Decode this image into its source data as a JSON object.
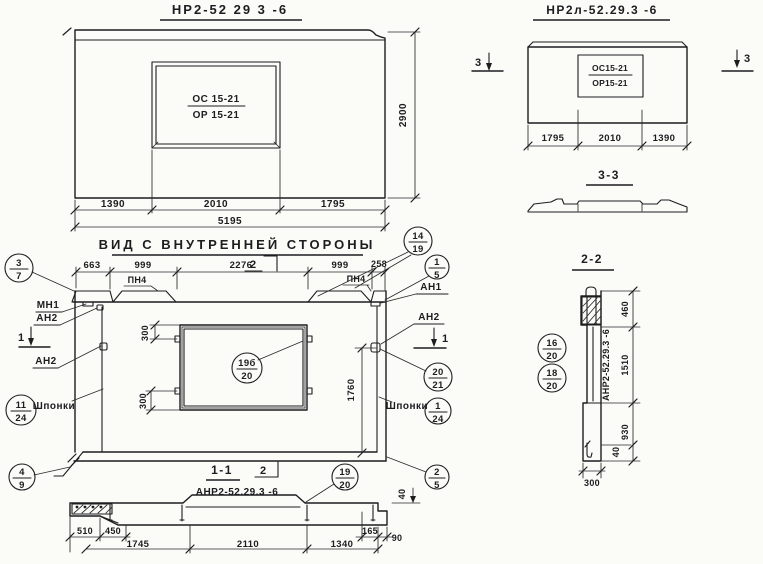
{
  "colors": {
    "ink": "#1d1d20",
    "paper": "#fbfbf8"
  },
  "facade": {
    "title": "НР2-52 29 3 -6",
    "win_top": "ОС 15-21",
    "win_bot": "ОР 15-21",
    "d1": "1390",
    "d2": "2010",
    "d3": "1795",
    "total": "5195",
    "height": "2900"
  },
  "facade_l": {
    "title": "НР2л-52.29.3 -6",
    "win_top": "ОС15-21",
    "win_bot": "ОР15-21",
    "d1": "1795",
    "d2": "2010",
    "d3": "1390",
    "cut_mark": "3",
    "sec_title": "3-3"
  },
  "inner": {
    "title": "ВИД С ВНУТРЕННЕЙ СТОРОНЫ",
    "dims": [
      "663",
      "999",
      "2276",
      "999",
      "258"
    ],
    "pn4": "ПН4",
    "mn1": "МН1",
    "an1": "АН1",
    "an2": "АН2",
    "keys": "Шпонки",
    "cut1": "1",
    "cut2": "2",
    "d300": "300",
    "d1760": "1760"
  },
  "sec11": {
    "title": "1-1",
    "label": "АНР2-52.29.3 -6",
    "d510": "510",
    "d450": "450",
    "d1745": "1745",
    "d2110": "2110",
    "d1340": "1340",
    "d165": "165",
    "d90": "90",
    "d40": "40"
  },
  "sec22": {
    "title": "2-2",
    "label": "АНР2-52.29.3 -6",
    "d460": "460",
    "d1510": "1510",
    "d930": "930",
    "d40": "40",
    "d300": "300"
  },
  "callouts": {
    "c3_7": {
      "top": "3",
      "bottom": "7"
    },
    "c14_19": {
      "top": "14",
      "bottom": "19"
    },
    "c1_5": {
      "top": "1",
      "bottom": "5"
    },
    "c19b_20": {
      "top": "19б",
      "bottom": "20"
    },
    "c20_21": {
      "top": "20",
      "bottom": "21"
    },
    "c1_24": {
      "top": "1",
      "bottom": "24"
    },
    "c11_24": {
      "top": "11",
      "bottom": "24"
    },
    "c4_9": {
      "top": "4",
      "bottom": "9"
    },
    "c2_5": {
      "top": "2",
      "bottom": "5"
    },
    "c19_20": {
      "top": "19",
      "bottom": "20"
    },
    "c16_20": {
      "top": "16",
      "bottom": "20"
    },
    "c18_20": {
      "top": "18",
      "bottom": "20"
    }
  }
}
